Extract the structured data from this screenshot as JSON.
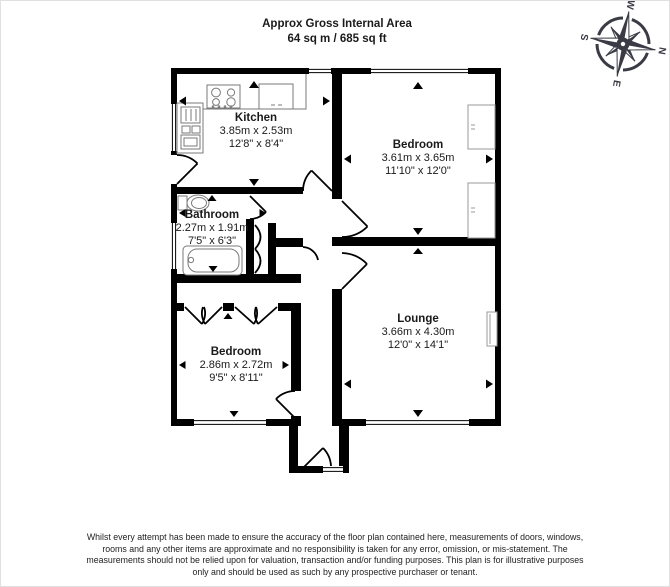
{
  "title": {
    "line1": "Approx Gross Internal Area",
    "line2": "64 sq m / 685 sq ft"
  },
  "compass": {
    "n": "N",
    "e": "E",
    "s": "S",
    "w": "W",
    "rotation_deg": 100
  },
  "rooms": {
    "kitchen": {
      "name": "Kitchen",
      "metric": "3.85m x 2.53m",
      "imperial": "12'8\" x 8'4\""
    },
    "bedroom1": {
      "name": "Bedroom",
      "metric": "3.61m x 3.65m",
      "imperial": "11'10\" x 12'0\""
    },
    "bathroom": {
      "name": "Bathroom",
      "metric": "2.27m x 1.91m",
      "imperial": "7'5\" x 6'3\""
    },
    "bedroom2": {
      "name": "Bedroom",
      "metric": "2.86m x 2.72m",
      "imperial": "9'5\" x 8'11\""
    },
    "lounge": {
      "name": "Lounge",
      "metric": "3.66m x 4.30m",
      "imperial": "12'0\" x 14'1\""
    }
  },
  "disclaimer": "Whilst every attempt has been made to ensure the accuracy of the floor plan contained here, measurements of doors, windows, rooms and any other items are approximate and no responsibility is taken for any error, omission, or mis-statement. The measurements should not be relied upon for valuation, transaction and/or funding purposes. This plan is for illustrative purposes only and should be used as such by any prospective purchaser or tenant.",
  "colors": {
    "wall": "#000000",
    "fixture_outline": "#7a7a7a",
    "compass": "#3b3b46",
    "text": "#1a1a1a"
  }
}
